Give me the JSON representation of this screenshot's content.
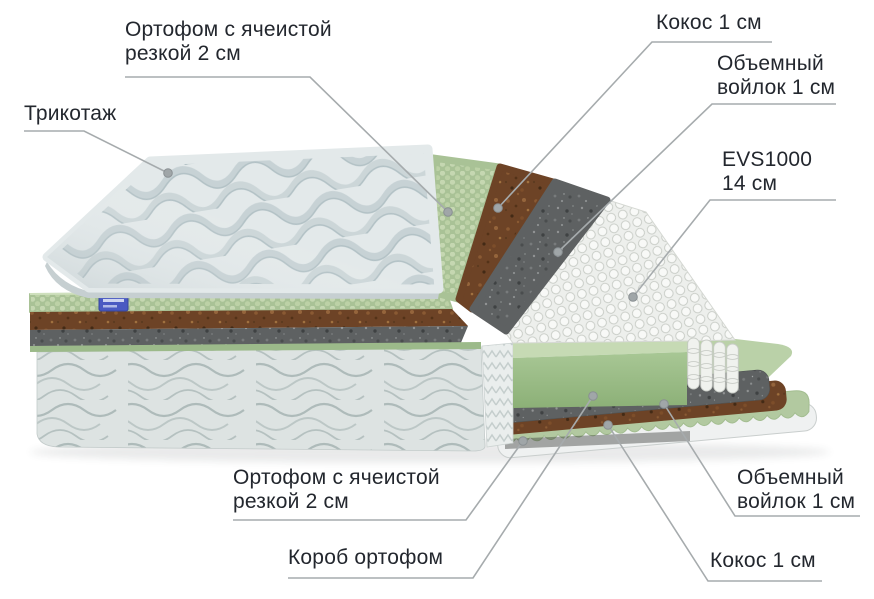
{
  "title": "Схема слоев матраса",
  "canvas": {
    "width": 874,
    "height": 599,
    "background": "#ffffff"
  },
  "labels": [
    {
      "id": "tricot",
      "lines": [
        "Трикотаж"
      ]
    },
    {
      "id": "orthofoam-top",
      "lines": [
        "Ортофом с ячеистой",
        "резкой 2 см"
      ]
    },
    {
      "id": "coconut-top",
      "lines": [
        "Кокос 1 см"
      ]
    },
    {
      "id": "felt-top",
      "lines": [
        "Объемный",
        "войлок 1 см"
      ]
    },
    {
      "id": "evs",
      "lines": [
        "EVS1000",
        "14 см"
      ]
    },
    {
      "id": "orthofoam-bottom",
      "lines": [
        "Ортофом с ячеистой",
        "резкой 2 см"
      ]
    },
    {
      "id": "box",
      "lines": [
        "Короб ортофом"
      ]
    },
    {
      "id": "felt-bottom",
      "lines": [
        "Объемный",
        "войлок 1 см"
      ]
    },
    {
      "id": "coconut-bottom",
      "lines": [
        "Кокос 1 см"
      ]
    }
  ],
  "layers_top_to_bottom": [
    "Трикотаж",
    "Ортофом с ячеистой резкой 2 см",
    "Кокос 1 см",
    "Объемный войлок 1 см",
    "EVS1000 14 см",
    "Короб ортофом",
    "Объемный войлок 1 см",
    "Кокос 1 см",
    "Ортофом с ячеистой резкой 2 см"
  ],
  "colors": {
    "background": "#ffffff",
    "label_text": "#23272e",
    "leader_line": "#a6abad",
    "tricot_fabric": "#e3e9ea",
    "foam_green": "#a9c296",
    "foam_green_light": "#c5d7b1",
    "coconut_brown": "#6d4326",
    "felt_gray": "#5e6162",
    "springs_white": "#eef0ec",
    "box_green": "#a8c795",
    "body_fabric": "#dde3e2",
    "tag_blue": "#4a5ac2"
  }
}
